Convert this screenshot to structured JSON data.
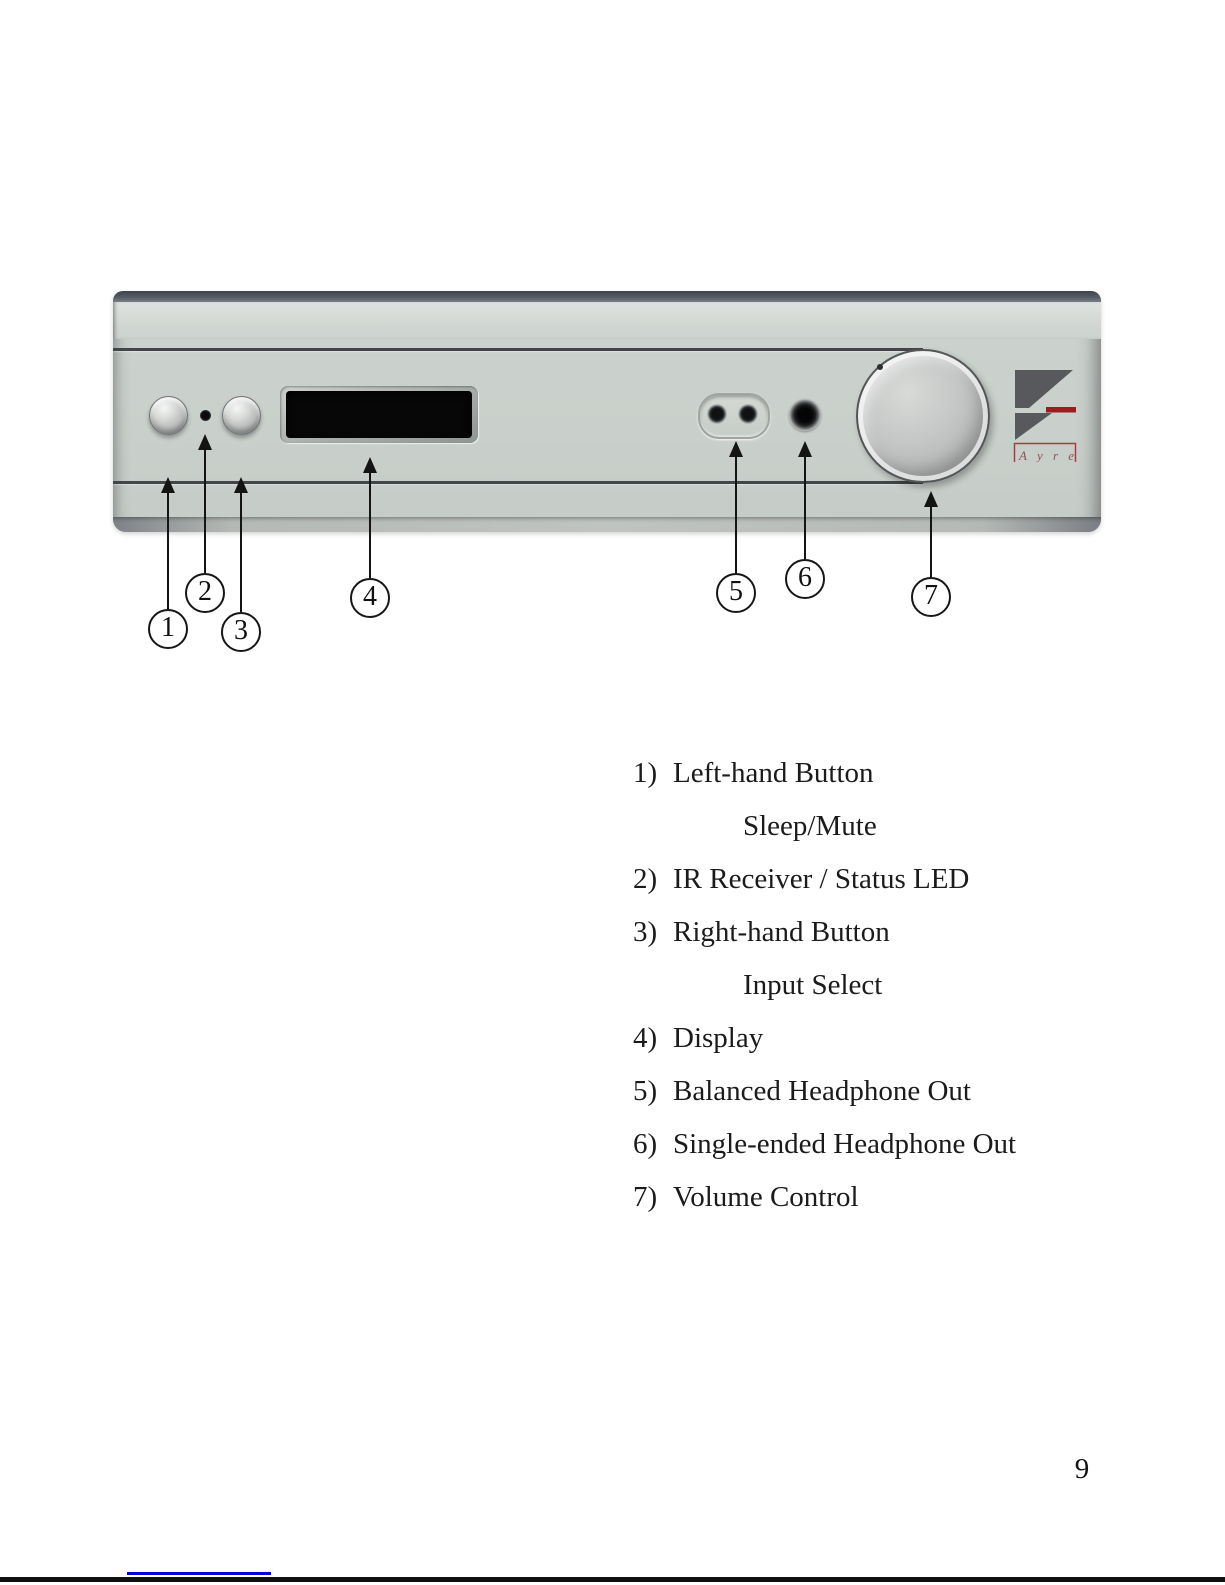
{
  "page": {
    "number": "9"
  },
  "panel": {
    "logo": {
      "wordmark": "A y r e"
    }
  },
  "colors": {
    "panel_face": "#c9cfca",
    "logo_gray": "#58595d",
    "logo_red": "#9e1c1f",
    "wordmark_border_red": "#ad3c3c",
    "link_blue": "#0000dd"
  },
  "callouts": [
    {
      "number": "1"
    },
    {
      "number": "2"
    },
    {
      "number": "3"
    },
    {
      "number": "4"
    },
    {
      "number": "5"
    },
    {
      "number": "6"
    },
    {
      "number": "7"
    }
  ],
  "legend": {
    "items": [
      {
        "number": "1)",
        "label": "Left-hand Button",
        "sub": "Sleep/Mute"
      },
      {
        "number": "2)",
        "label": "IR Receiver / Status LED"
      },
      {
        "number": "3)",
        "label": "Right-hand Button",
        "sub": "Input Select"
      },
      {
        "number": "4)",
        "label": "Display"
      },
      {
        "number": "5)",
        "label": "Balanced Headphone Out"
      },
      {
        "number": "6)",
        "label": "Single-ended Headphone Out"
      },
      {
        "number": "7)",
        "label": "Volume Control"
      }
    ]
  }
}
